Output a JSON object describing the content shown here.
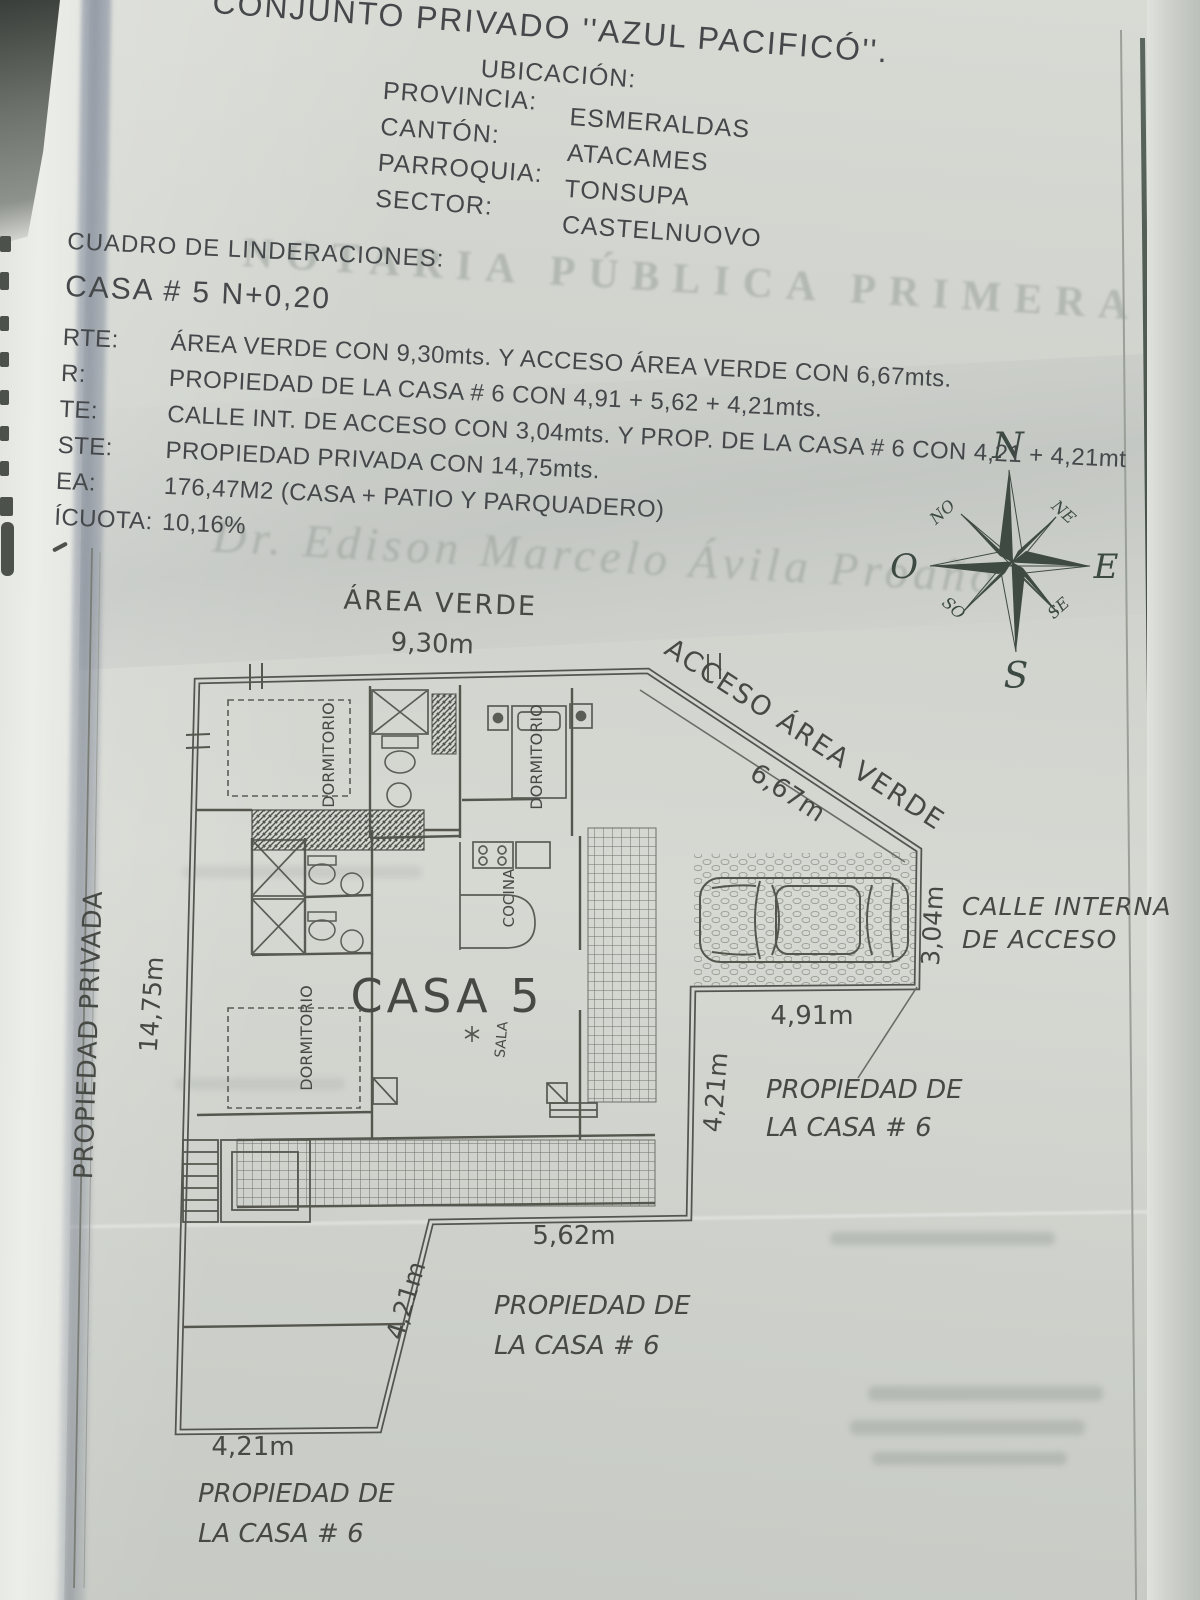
{
  "header": {
    "title": "CONJUNTO PRIVADO ''AZUL PACIFICÓ''.",
    "ubicacion_label": "UBICACIÓN:",
    "fields": [
      {
        "label": "PROVINCIA:",
        "value": "ESMERALDAS"
      },
      {
        "label": "CANTÓN:",
        "value": "ATACAMES"
      },
      {
        "label": "PARROQUIA:",
        "value": "TONSUPA"
      },
      {
        "label": "SECTOR:",
        "value": "CASTELNUOVO"
      }
    ]
  },
  "linderos": {
    "section_title": "CUADRO DE LINDERACIONES:",
    "casa_line": "CASA # 5 N+0,20",
    "rows": [
      {
        "label": "RTE:",
        "text": "ÁREA VERDE CON 9,30mts. Y ACCESO ÁREA VERDE CON 6,67mts."
      },
      {
        "label": "R:",
        "text": "PROPIEDAD DE LA CASA # 6 CON 4,91 + 5,62 + 4,21mts."
      },
      {
        "label": "TE:",
        "text": "CALLE INT. DE ACCESO CON 3,04mts. Y PROP. DE LA CASA # 6 CON 4,21 + 4,21mt"
      },
      {
        "label": "STE:",
        "text": "PROPIEDAD PRIVADA CON 14,75mts."
      },
      {
        "label": "EA:",
        "text": "176,47M2    (CASA + PATIO Y PARQUADERO)"
      },
      {
        "label": "ÍCUOTA:",
        "text": "10,16%"
      }
    ]
  },
  "compass": {
    "n": "N",
    "s": "S",
    "e": "E",
    "o": "O",
    "no": "NO",
    "ne": "NE",
    "so": "SO",
    "se": "SE"
  },
  "plan": {
    "casa_label": "CASA 5",
    "labels": {
      "area_verde": "ÁREA VERDE",
      "dim_top": "9,30m",
      "acceso": "ACCESO ÁREA VERDE",
      "dim_acceso": "6,67m",
      "dim_calle": "3,04m",
      "calle_1": "CALLE INTERNA",
      "calle_2": "DE ACCESO",
      "dim_parqueo": "4,91m",
      "dim_este": "4,21m",
      "dim_sur": "5,62m",
      "dim_sur_diag": "4,21m",
      "dim_sw": "4,21m",
      "dim_oeste": "14,75m",
      "prop_privada": "PROPIEDAD PRIVADA",
      "prop_de": "PROPIEDAD DE",
      "la_casa_6": "LA CASA # 6",
      "dormitorio": "DORMITORIO",
      "cocina": "COCINA",
      "sala": "SALA"
    }
  },
  "watermarks": {
    "notaria": "NOTARIA PÚBLICA PRIMERA",
    "doctor": "Dr. Edison Marcelo Ávila Proaño"
  }
}
